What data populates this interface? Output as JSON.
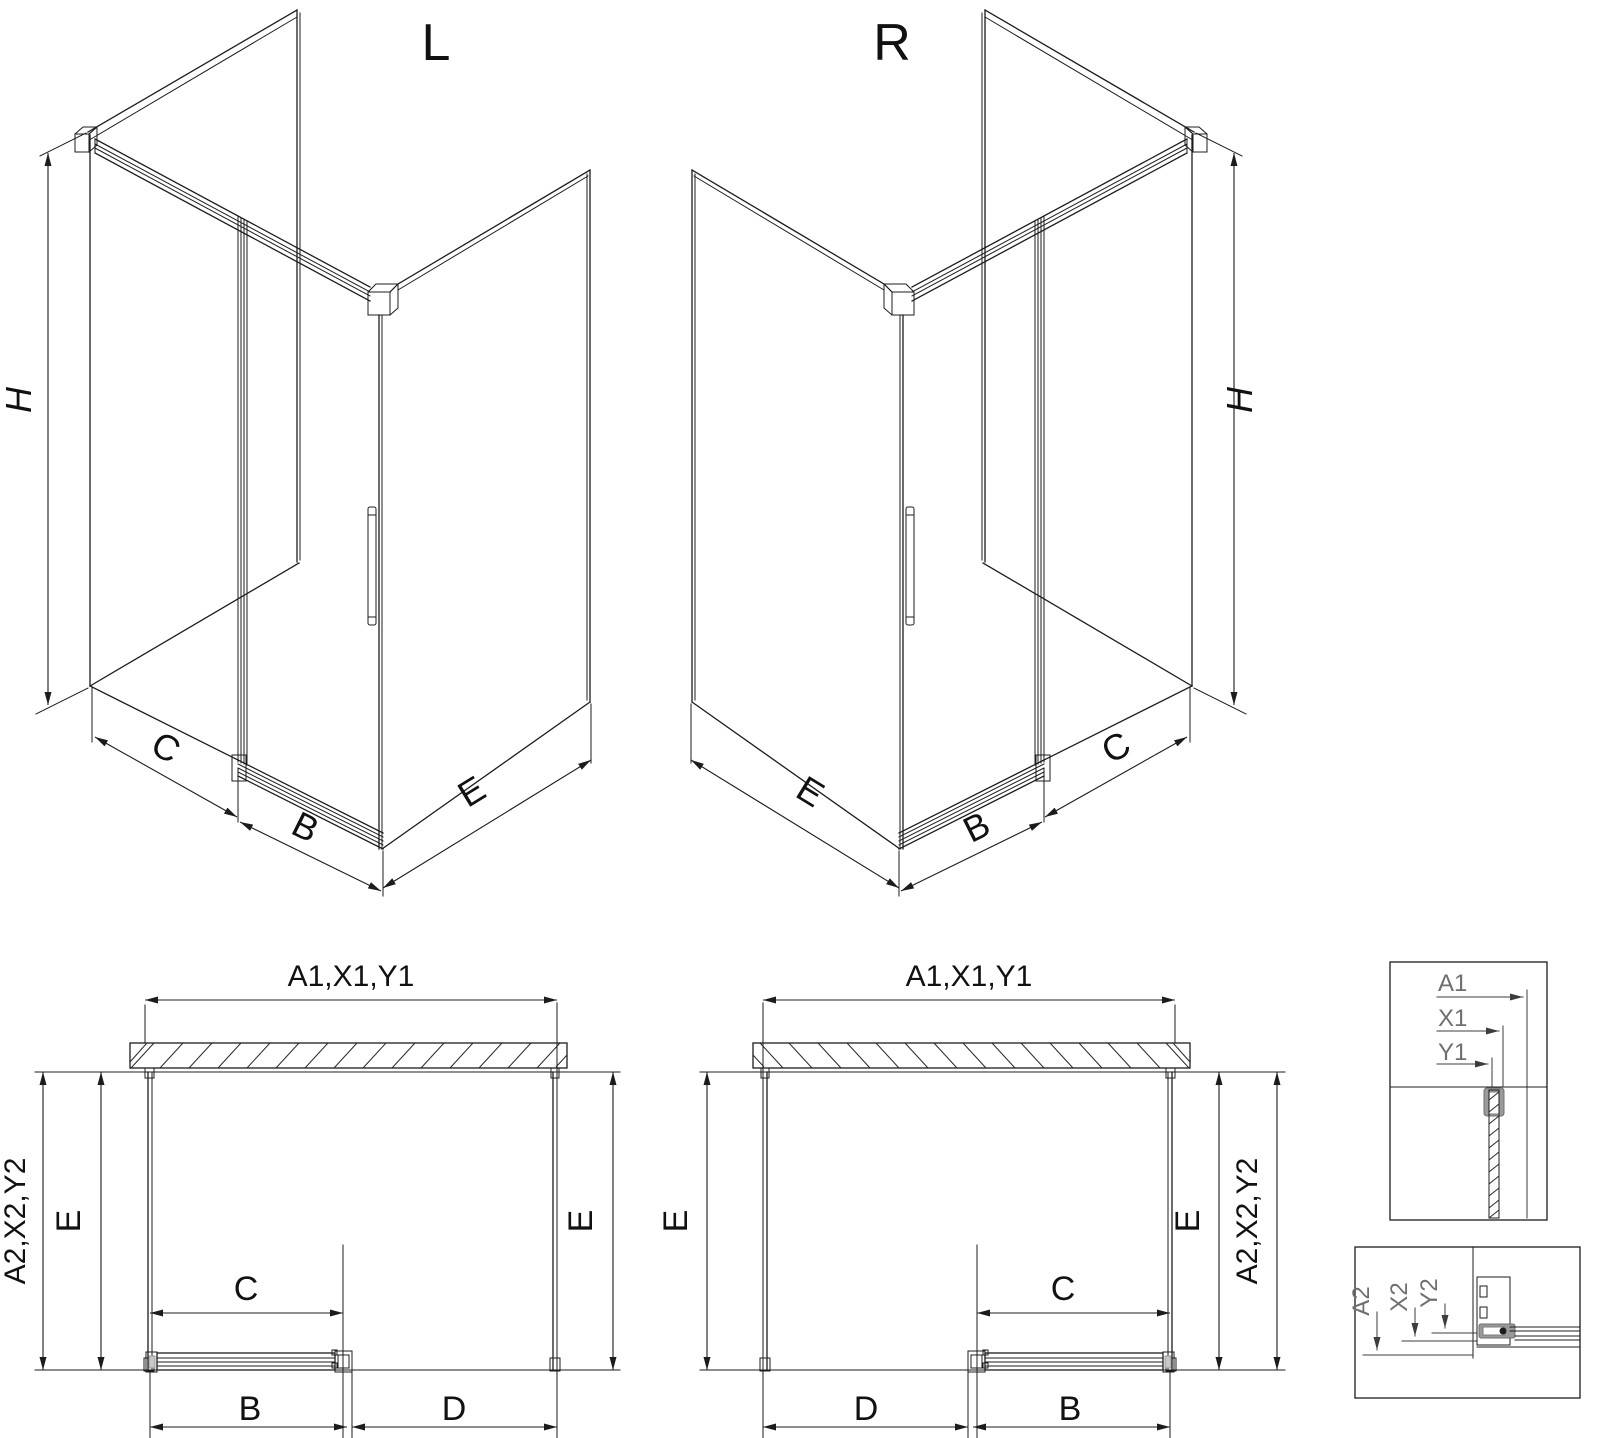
{
  "colors": {
    "line": "#1c1c1c",
    "detail_gray": "#9a9a9a",
    "detail_label_gray": "#6f6f6f",
    "background": "#ffffff"
  },
  "iso_left": {
    "title": "L",
    "height": "H",
    "fixed": "C",
    "door": "B",
    "side": "E"
  },
  "iso_right": {
    "title": "R",
    "height": "H",
    "fixed": "C",
    "door": "B",
    "side": "E"
  },
  "plan_left": {
    "top": "A1,X1,Y1",
    "side": "A2,X2,Y2",
    "depth_left": "E",
    "depth_right": "E",
    "fixed": "C",
    "door": "B",
    "opening": "D"
  },
  "plan_right": {
    "top": "A1,X1,Y1",
    "side": "A2,X2,Y2",
    "depth_left": "E",
    "depth_right": "E",
    "fixed": "C",
    "door": "B",
    "opening": "D"
  },
  "detail_top": {
    "labels": [
      "A1",
      "X1",
      "Y1"
    ]
  },
  "detail_bottom": {
    "labels": [
      "A2",
      "X2",
      "Y2"
    ]
  }
}
